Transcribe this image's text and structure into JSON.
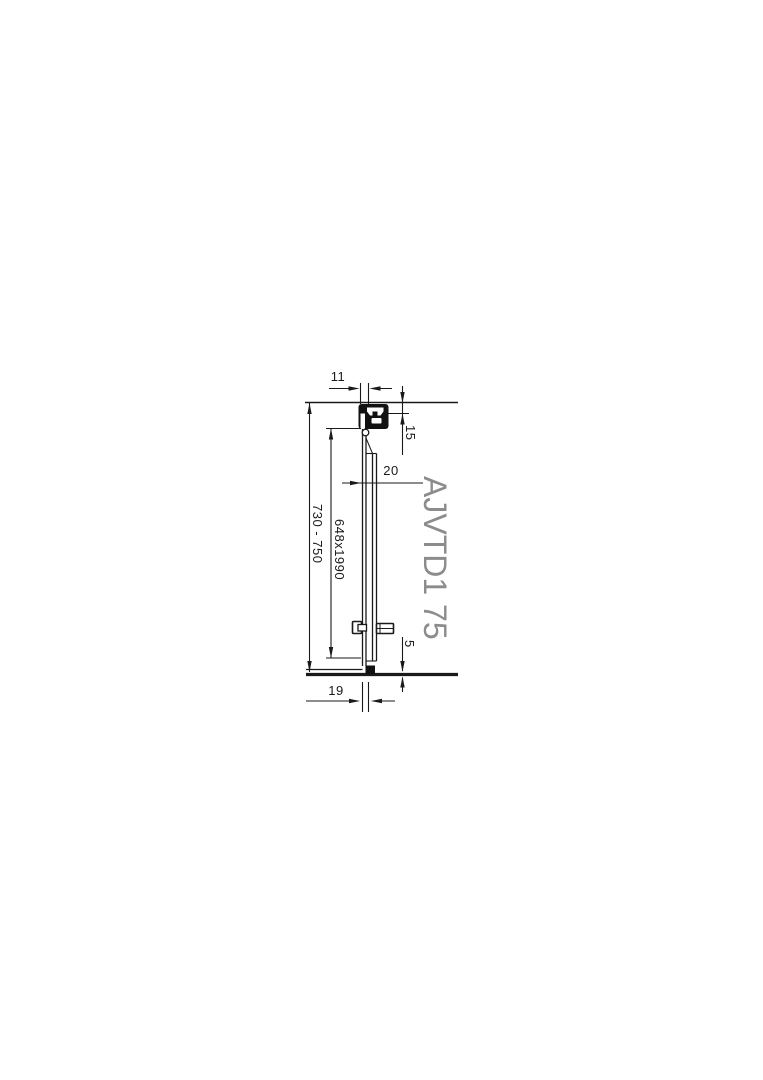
{
  "page": {
    "background": "#ffffff"
  },
  "drawing": {
    "product_code": "AJVTD1 75",
    "dimensions": {
      "top_width": "11",
      "top_profile_height": "15",
      "panel_thickness": "20",
      "height_range": "730 - 750",
      "glass_size": "648x1990",
      "floor_gap": "5",
      "bottom_width": "19"
    },
    "colors": {
      "line": "#1a1a1a",
      "product_code_text": "#8c8c8c"
    }
  }
}
